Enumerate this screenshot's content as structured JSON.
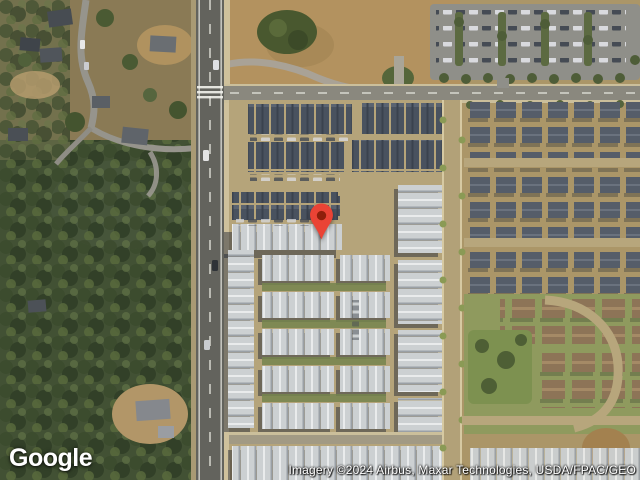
{
  "map": {
    "logo_text": "Google",
    "attribution_text": "Imagery ©2024 Airbus, Maxar Technologies, USDA/FPAC/GEO",
    "view_type": "satellite",
    "pin": {
      "label": "location-marker",
      "color": "#EA4335",
      "inner_color": "#8E1F0B"
    },
    "colors": {
      "forest_green": "#425134",
      "field_tan": "#b3925f",
      "main_road_gray": "#63635d",
      "street_tan": "#b5a47a",
      "roof_dark": "#49525f",
      "roof_light": "#ccd0d2",
      "roof_brown": "#8d7457",
      "lawn_green": "#8f9a5e"
    }
  }
}
